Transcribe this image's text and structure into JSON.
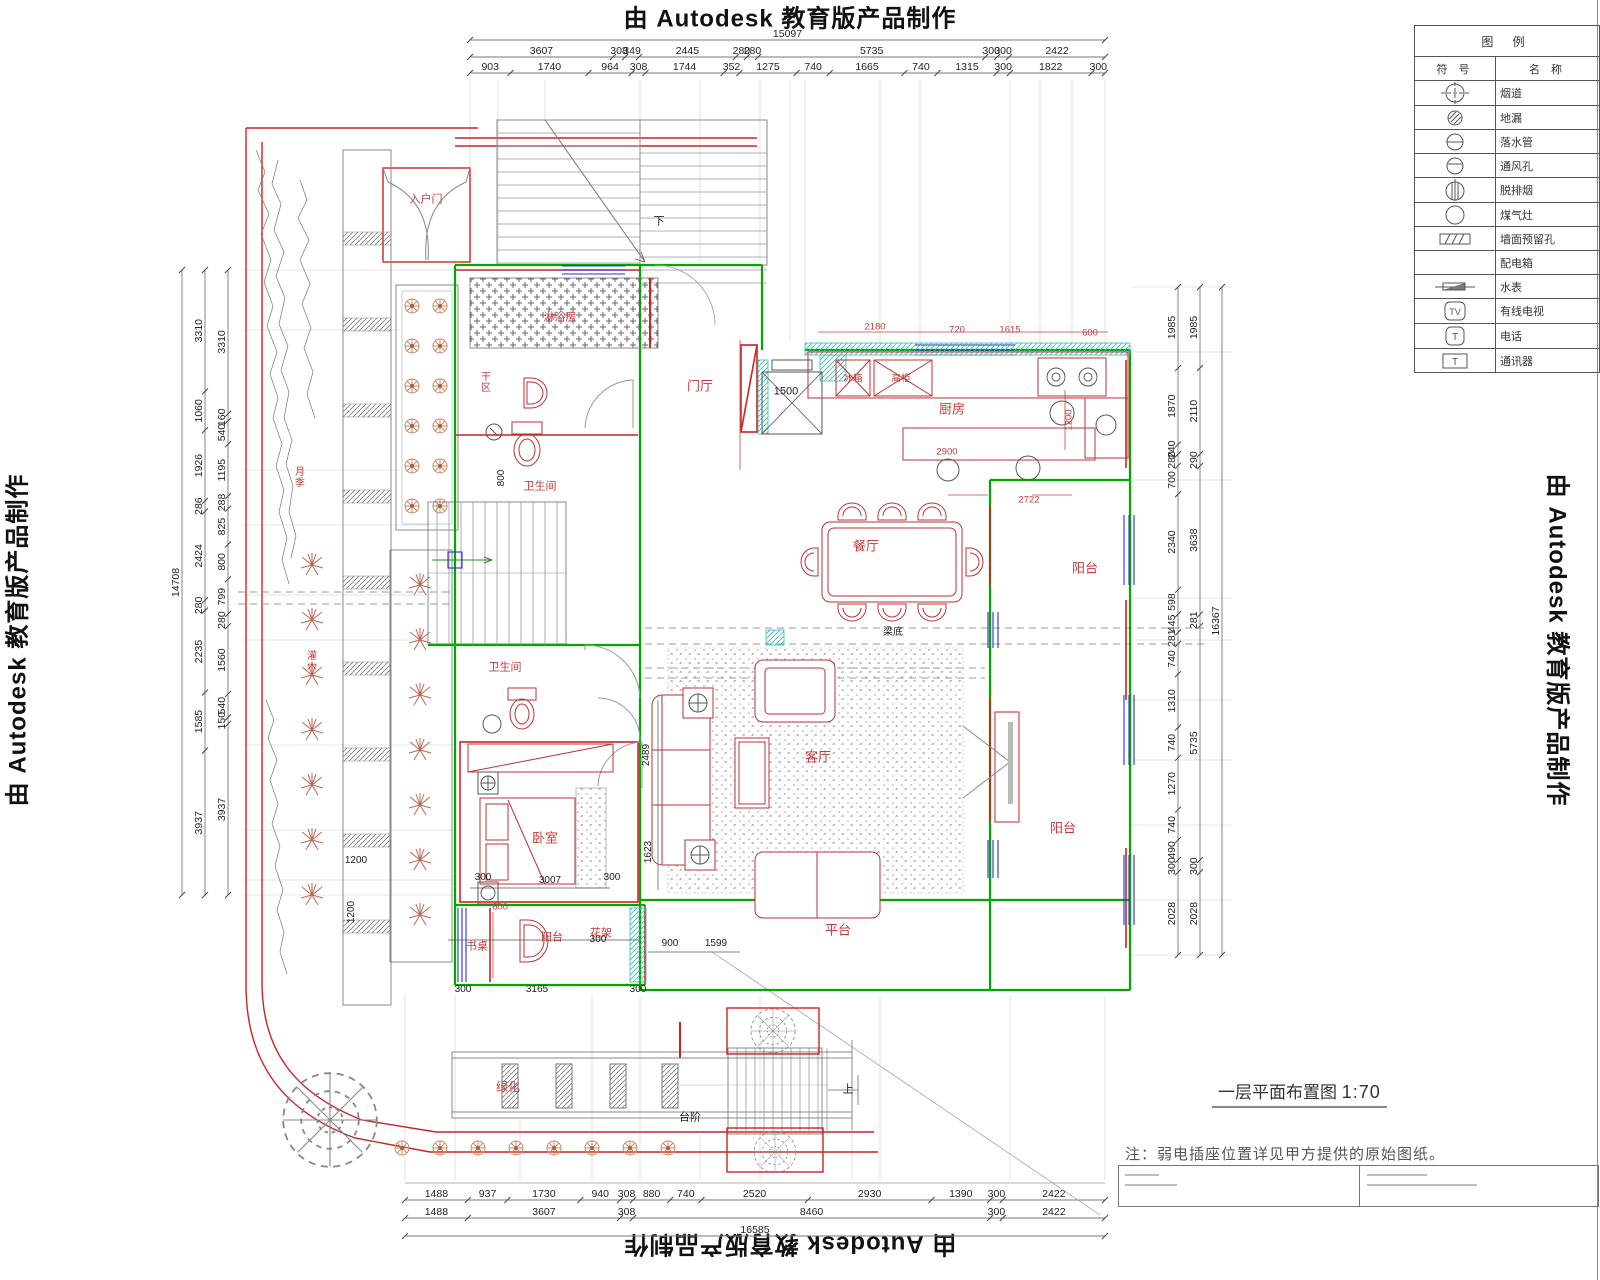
{
  "watermark": {
    "text": "由 Autodesk 教育版产品制作"
  },
  "legend": {
    "title": "图 例",
    "col_symbol": "符 号",
    "col_name": "名 称",
    "rows": [
      {
        "icon": "flue-icon",
        "name": "烟道"
      },
      {
        "icon": "floor-drain-icon",
        "name": "地漏"
      },
      {
        "icon": "downpipe-icon",
        "name": "落水管"
      },
      {
        "icon": "vent-icon",
        "name": "通风孔"
      },
      {
        "icon": "range-hood-icon",
        "name": "脱排烟"
      },
      {
        "icon": "gas-stove-icon",
        "name": "煤气灶"
      },
      {
        "icon": "wall-hole-icon",
        "name": "墙面预留孔"
      },
      {
        "icon": "none",
        "name": "配电箱"
      },
      {
        "icon": "water-meter-icon",
        "name": "水表"
      },
      {
        "icon": "cable-tv-icon",
        "name": "有线电视"
      },
      {
        "icon": "phone-icon",
        "name": "电话"
      },
      {
        "icon": "intercom-icon",
        "name": "通讯器"
      }
    ]
  },
  "title_block": {
    "drawing_title": "一层平面布置图",
    "scale": "1:70",
    "note": "注：弱电插座位置详见甲方提供的原始图纸。"
  },
  "dims": {
    "top": {
      "total": 15097,
      "row1": [
        3607,
        308,
        349,
        2445,
        280,
        280,
        5735,
        300,
        300,
        2422
      ],
      "row2": [
        903,
        1740,
        964,
        308,
        1744,
        352,
        1275,
        740,
        1665,
        740,
        1315,
        300,
        1822,
        300
      ]
    },
    "bottom": {
      "row1": [
        1488,
        937,
        1730,
        940,
        308,
        880,
        740,
        2520,
        2930,
        1390,
        300,
        2422
      ],
      "row2": [
        1488,
        3607,
        308,
        8460,
        300,
        2422
      ],
      "total": 16585
    },
    "left": {
      "total": 14708,
      "mid": [
        3310,
        1060,
        1926,
        286,
        2424,
        280,
        2235,
        1585,
        3937
      ],
      "inner": [
        3310,
        160,
        540,
        1195,
        288,
        825,
        800,
        799,
        280,
        1560,
        540,
        150,
        3937
      ]
    },
    "right": {
      "inner": [
        1985,
        1870,
        240,
        280,
        700,
        2340,
        598,
        445,
        281,
        740,
        1310,
        740,
        1270,
        740,
        490,
        300,
        2028
      ],
      "mid": [
        1985,
        2110,
        290,
        3638,
        281,
        5735,
        300,
        2028
      ],
      "total": 16367
    }
  },
  "rooms": {
    "menting": "门厅",
    "chufang": "厨房",
    "canting": "餐厅",
    "keting": "客厅",
    "yangtai1": "阳台",
    "yangtai2": "阳台",
    "pingtai": "平台",
    "woshi": "卧室",
    "wsj1": "卫生间",
    "wsj2": "卫生间",
    "linyufang": "淋浴房",
    "ganqu": "干区",
    "yangtai3": "阳台",
    "shuzhuo": "书桌",
    "huajia": "花架",
    "lvhua": "绿化",
    "taijie": "台阶",
    "rhm": "入户门",
    "liangdi": "梁底",
    "bingxiang": "冰箱",
    "gaogui": "高柜",
    "shang": "上",
    "xia": "下",
    "yueji": "月季",
    "guanmu": "灌木"
  },
  "plan_dims": {
    "d2180": "2180",
    "d720": "720",
    "d1615": "1615",
    "d600a": "600",
    "d1500": "1500",
    "d2900": "2900",
    "d1200a": "1200",
    "d2722": "2722",
    "d2489": "2489",
    "d1623": "1623",
    "d3007": "3007",
    "d300a": "300",
    "d300b": "300",
    "d600b": "600",
    "d900": "900",
    "d1599": "1599",
    "d300c": "300",
    "d300d": "300",
    "d3165": "3165",
    "d300e": "300",
    "d800": "800",
    "d1200b": "1200",
    "d1200c": "1200"
  }
}
